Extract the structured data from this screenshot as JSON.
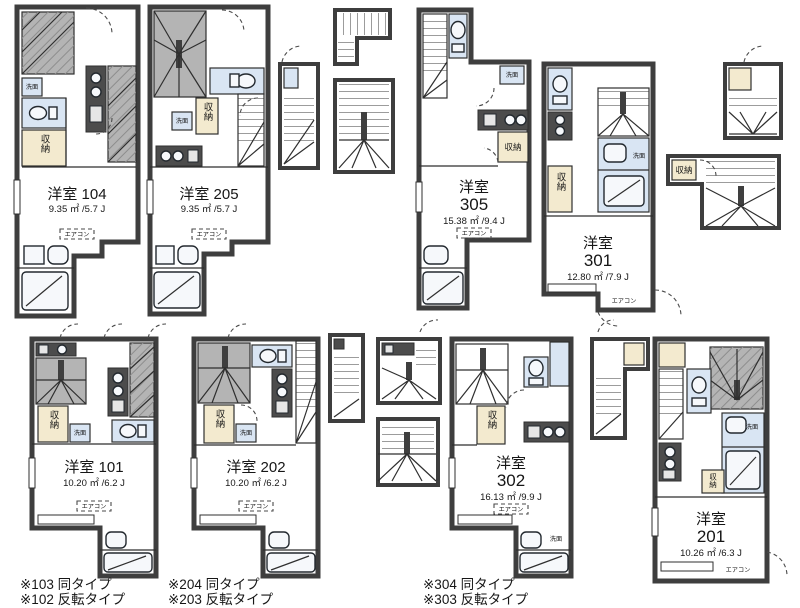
{
  "units": [
    {
      "room": "104",
      "title1": "洋室 104",
      "title2": "",
      "area": "9.35 ㎡ /5.7 J"
    },
    {
      "room": "205",
      "title1": "洋室 205",
      "title2": "",
      "area": "9.35 ㎡ /5.7 J"
    },
    {
      "room": "305",
      "title1": "洋室",
      "title2": "305",
      "area": "15.38 ㎡ /9.4 J"
    },
    {
      "room": "301",
      "title1": "洋室",
      "title2": "301",
      "area": "12.80 ㎡ /7.9 J"
    },
    {
      "room": "101",
      "title1": "洋室 101",
      "title2": "",
      "area": "10.20 ㎡ /6.2 J"
    },
    {
      "room": "202",
      "title1": "洋室 202",
      "title2": "",
      "area": "10.20 ㎡ /6.2 J"
    },
    {
      "room": "302",
      "title1": "洋室",
      "title2": "302",
      "area": "16.13 ㎡ /9.9 J"
    },
    {
      "room": "201",
      "title1": "洋室",
      "title2": "201",
      "area": "10.26 ㎡ /6.3 J"
    }
  ],
  "labels": {
    "closet": "収納",
    "washstand": "洗面",
    "aircon": "エアコン"
  },
  "notes": [
    {
      "line1": "※103 同タイプ",
      "line2": "※102 反転タイプ"
    },
    {
      "line1": "※204 同タイプ",
      "line2": "※203 反転タイプ"
    },
    {
      "line1": "※304 同タイプ",
      "line2": "※303 反転タイプ"
    }
  ],
  "colors": {
    "wall": "#3e3e3e",
    "stair_gray": "#b4b4b4",
    "water_blue": "#d9e5f3",
    "closet_tan": "#f3eacf"
  }
}
